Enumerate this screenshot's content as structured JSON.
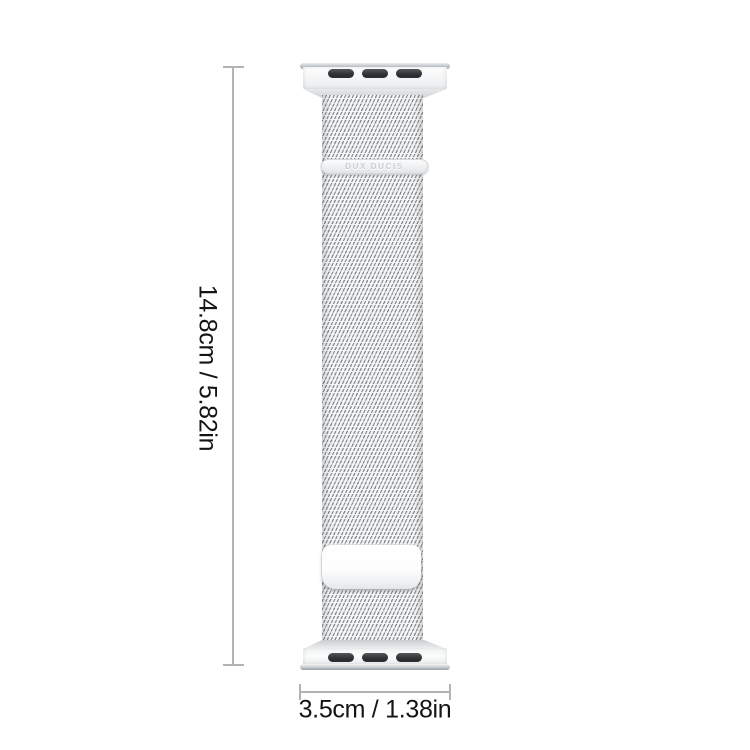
{
  "product": {
    "type_label": "milanese-watch-band",
    "brand_label": "DUX DUCIS"
  },
  "dimensions": {
    "height_label": "14.8cm / 5.82in",
    "width_label": "3.5cm / 1.38in"
  },
  "colors": {
    "dim_line": "#b3b3b3",
    "label_text": "#141414",
    "slot_dark": "#2c2f32",
    "brand_text": "#c9cdd1",
    "band_silver": "#e8eaec",
    "background": "#ffffff"
  }
}
